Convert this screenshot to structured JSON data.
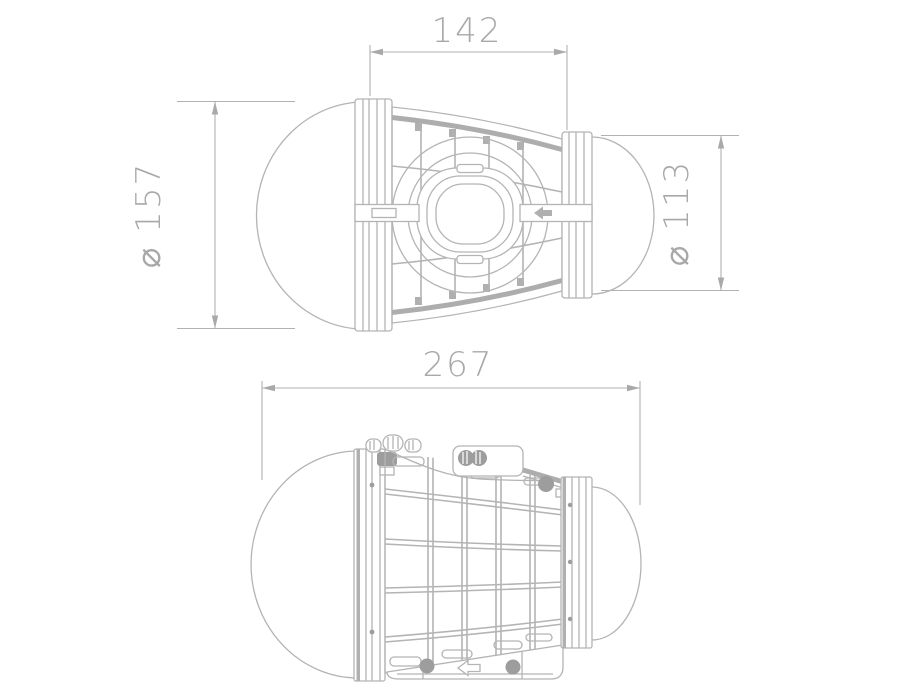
{
  "style": {
    "background": "#ffffff",
    "line_color": "#b4b4b4",
    "text_color": "#a8a8a8",
    "detail_fill": "#9d9d9d"
  },
  "dimensions": {
    "cage_length": "142",
    "large_dome_diameter": "⌀ 157",
    "small_dome_diameter": "⌀ 113",
    "overall_length": "267"
  }
}
